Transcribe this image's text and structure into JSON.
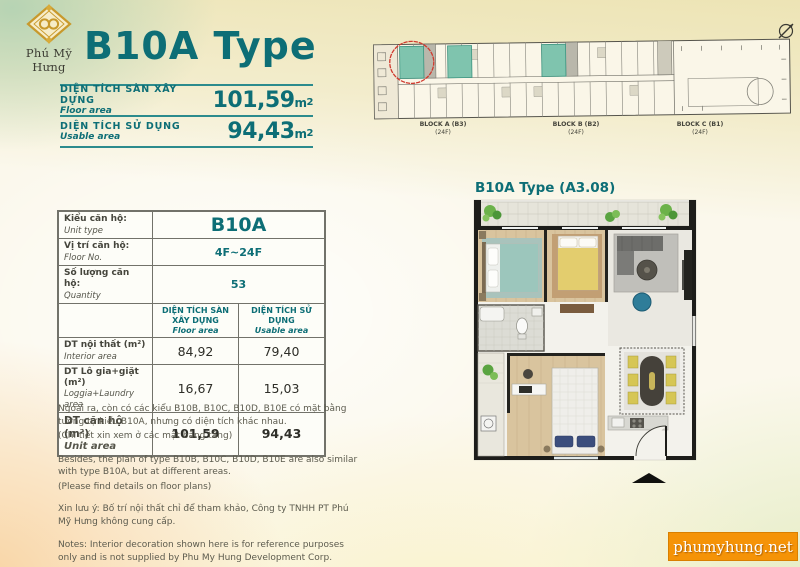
{
  "brand": {
    "name": "Phú Mỹ Hưng",
    "watermark": "phumyhung.net",
    "accent_teal": "#0d6e76",
    "accent_orange": "#f59307"
  },
  "header": {
    "title": "B10A Type",
    "areas": [
      {
        "label_vi": "DIỆN TÍCH SÀN XÂY DỰNG",
        "label_en": "Floor area",
        "value": "101,59",
        "unit": "m",
        "sup": "2"
      },
      {
        "label_vi": "DIỆN TÍCH SỬ DỤNG",
        "label_en": "Usable area",
        "value": "94,43",
        "unit": "m",
        "sup": "2"
      }
    ]
  },
  "site_plan": {
    "blocks": [
      {
        "name": "BLOCK A (B3)",
        "floors": "(24F)"
      },
      {
        "name": "BLOCK B (B2)",
        "floors": "(24F)"
      },
      {
        "name": "BLOCK C (B1)",
        "floors": "(24F)"
      }
    ]
  },
  "unit_table": {
    "info_rows": [
      {
        "label_vi": "Kiểu căn hộ:",
        "label_en": "Unit type",
        "value": "B10A"
      },
      {
        "label_vi": "Vị trí căn hộ:",
        "label_en": "Floor No.",
        "value": "4F~24F"
      },
      {
        "label_vi": "Số lượng căn hộ:",
        "label_en": "Quantity",
        "value": "53"
      }
    ],
    "col_headers": [
      {
        "label_vi": "DIỆN TÍCH SÀN XÂY DỰNG",
        "label_en": "Floor area"
      },
      {
        "label_vi": "DIỆN TÍCH SỬ DỤNG",
        "label_en": "Usable area"
      }
    ],
    "area_rows": [
      {
        "label_vi": "DT nội thất  (m²)",
        "label_en": "Interior area",
        "floor": "84,92",
        "usable": "79,40"
      },
      {
        "label_vi": "DT Lô gia+giặt  (m²)",
        "label_en": "Loggia+Laundry area",
        "floor": "16,67",
        "usable": "15,03"
      },
      {
        "label_vi": "DT căn hộ (m²)",
        "label_en": "Unit area",
        "floor": "101,59",
        "usable": "94,43"
      }
    ]
  },
  "notes": {
    "besides_vi": "Ngoài ra, còn có các kiểu B10B, B10C, B10D, B10E có mặt bằng tương tự kiểu B10A, nhưng có diện tích khác nhau.",
    "besides_vi_detail": "(Chi tiết xin xem ở các mặt bằng tầng)",
    "besides_en": "Besides, the plan of type B10B, B10C, B10D, B10E are also similar with type B10A, but at different areas.",
    "besides_en_detail": "(Please find details on floor plans)",
    "notice_vi": "Xin lưu ý: Bố trí nội thất chỉ để tham khảo, Công ty TNHH PT Phú Mỹ Hưng không cung cấp.",
    "notice_en": "Notes: Interior decoration shown here is for reference purposes only and is not supplied by Phu My Hung Development Corp."
  },
  "plan": {
    "title": "B10A Type (A3.08)"
  }
}
